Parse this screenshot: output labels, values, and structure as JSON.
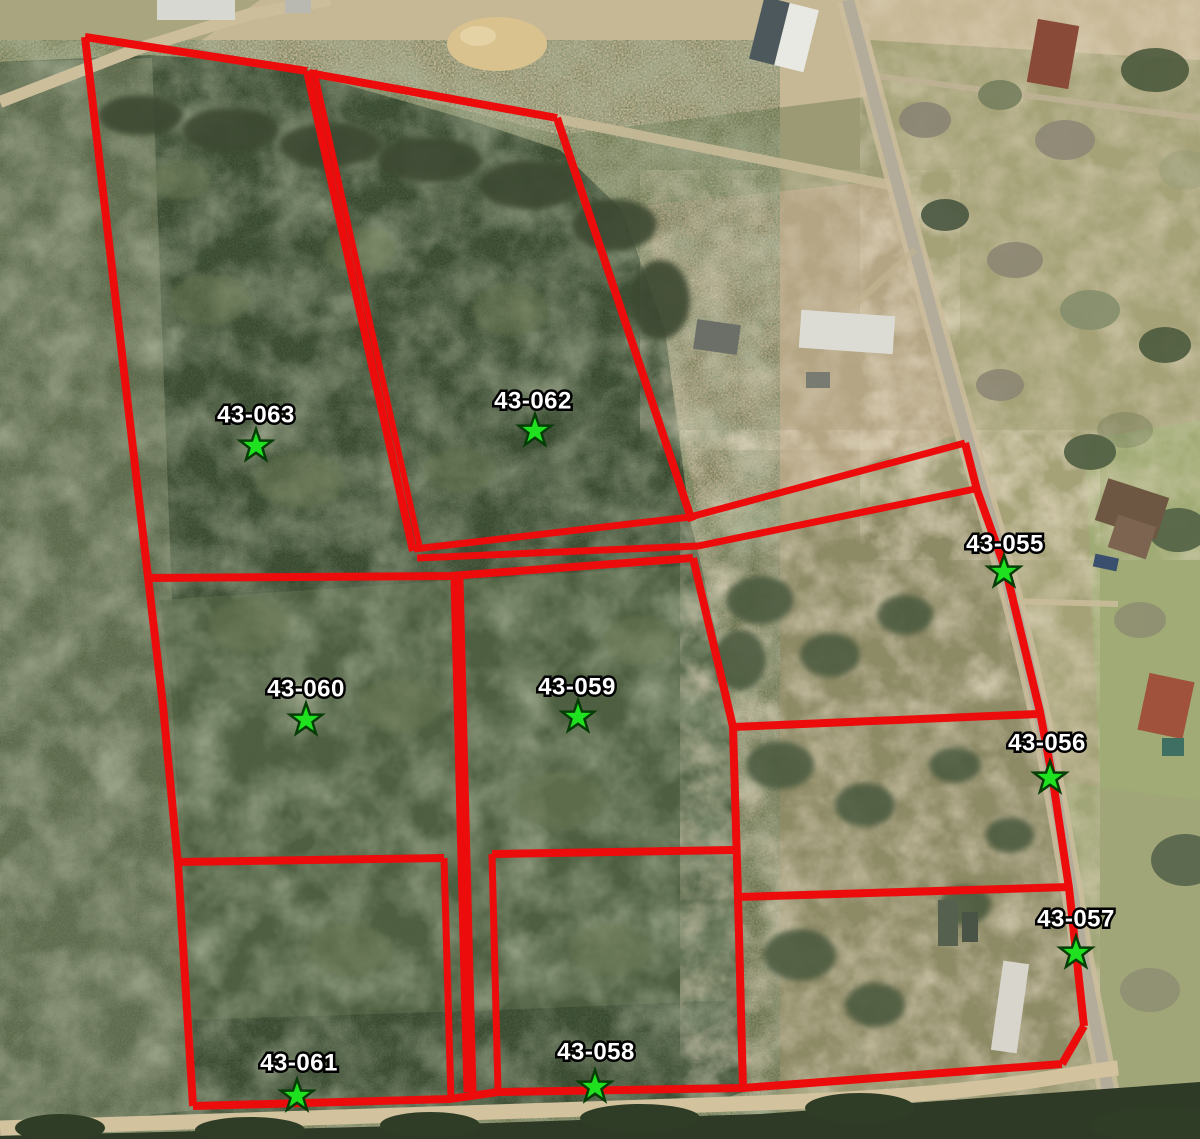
{
  "map": {
    "title": "Parcel overview aerial map",
    "boundary_color": "#ec0c0c",
    "marker": {
      "fill": "#1fe11f",
      "stroke": "#063c06",
      "outer_radius": 17,
      "inner_radius": 6.8
    },
    "label_style": {
      "fill": "#ffffff",
      "outline": "#000000"
    },
    "parcels": [
      {
        "id": "43-063",
        "label": {
          "x": 256,
          "y": 416
        },
        "star": {
          "x": 256,
          "y": 446
        }
      },
      {
        "id": "43-062",
        "label": {
          "x": 533,
          "y": 402
        },
        "star": {
          "x": 535,
          "y": 431
        }
      },
      {
        "id": "43-060",
        "label": {
          "x": 306,
          "y": 690
        },
        "star": {
          "x": 306,
          "y": 720
        }
      },
      {
        "id": "43-059",
        "label": {
          "x": 577,
          "y": 688
        },
        "star": {
          "x": 578,
          "y": 717
        }
      },
      {
        "id": "43-061",
        "label": {
          "x": 299,
          "y": 1064
        },
        "star": {
          "x": 297,
          "y": 1096
        }
      },
      {
        "id": "43-058",
        "label": {
          "x": 596,
          "y": 1053
        },
        "star": {
          "x": 595,
          "y": 1087
        }
      },
      {
        "id": "43-055",
        "label": {
          "x": 1005,
          "y": 545
        },
        "star": {
          "x": 1004,
          "y": 572
        }
      },
      {
        "id": "43-056",
        "label": {
          "x": 1047,
          "y": 744
        },
        "star": {
          "x": 1050,
          "y": 778
        }
      },
      {
        "id": "43-057",
        "label": {
          "x": 1076,
          "y": 920
        },
        "star": {
          "x": 1076,
          "y": 953
        }
      }
    ],
    "boundaries": [
      {
        "name": "west-line",
        "width": 8,
        "points": [
          [
            85,
            37
          ],
          [
            148,
            577
          ],
          [
            163,
            706
          ],
          [
            178,
            864
          ],
          [
            193,
            1106
          ]
        ]
      },
      {
        "name": "top-63",
        "width": 8,
        "points": [
          [
            85,
            37
          ],
          [
            307,
            71
          ]
        ]
      },
      {
        "name": "divider-63-62-a",
        "width": 8,
        "points": [
          [
            307,
            71
          ],
          [
            413,
            551
          ]
        ]
      },
      {
        "name": "divider-63-62-b",
        "width": 6,
        "points": [
          [
            314,
            70
          ],
          [
            420,
            548
          ]
        ]
      },
      {
        "name": "top-62",
        "width": 8,
        "points": [
          [
            309,
            73
          ],
          [
            557,
            118
          ]
        ]
      },
      {
        "name": "east-62",
        "width": 8,
        "points": [
          [
            557,
            118
          ],
          [
            692,
            521
          ]
        ]
      },
      {
        "name": "lane-north",
        "width": 7,
        "points": [
          [
            414,
            549
          ],
          [
            690,
            517
          ],
          [
            965,
            443
          ]
        ]
      },
      {
        "name": "lane-south",
        "width": 7,
        "points": [
          [
            417,
            558
          ],
          [
            698,
            546
          ],
          [
            975,
            489
          ]
        ]
      },
      {
        "name": "mid-line",
        "width": 8,
        "points": [
          [
            148,
            578
          ],
          [
            450,
            576
          ],
          [
            693,
            558
          ]
        ]
      },
      {
        "name": "corridor",
        "width": 13,
        "points": [
          [
            457,
            578
          ],
          [
            464,
            860
          ],
          [
            470,
            1092
          ]
        ]
      },
      {
        "name": "east-61",
        "width": 7,
        "points": [
          [
            444,
            858
          ],
          [
            451,
            1100
          ]
        ]
      },
      {
        "name": "west-58",
        "width": 7,
        "points": [
          [
            492,
            854
          ],
          [
            498,
            1091
          ]
        ]
      },
      {
        "name": "divider-60-61",
        "width": 8,
        "points": [
          [
            176,
            862
          ],
          [
            444,
            858
          ]
        ]
      },
      {
        "name": "top-58",
        "width": 8,
        "points": [
          [
            492,
            854
          ],
          [
            733,
            850
          ]
        ]
      },
      {
        "name": "east-center-line",
        "width": 8,
        "points": [
          [
            693,
            558
          ],
          [
            722,
            680
          ],
          [
            733,
            727
          ],
          [
            738,
            897
          ],
          [
            743,
            1089
          ]
        ]
      },
      {
        "name": "top-56",
        "width": 8,
        "points": [
          [
            733,
            727
          ],
          [
            1038,
            714
          ]
        ]
      },
      {
        "name": "top-57",
        "width": 8,
        "points": [
          [
            738,
            897
          ],
          [
            1069,
            887
          ]
        ]
      },
      {
        "name": "road-line",
        "width": 8,
        "points": [
          [
            965,
            443
          ],
          [
            977,
            490
          ],
          [
            1006,
            571
          ],
          [
            1040,
            712
          ],
          [
            1053,
            781
          ],
          [
            1069,
            888
          ],
          [
            1084,
            1026
          ]
        ]
      },
      {
        "name": "se-corner",
        "width": 8,
        "points": [
          [
            1084,
            1026
          ],
          [
            1062,
            1064
          ]
        ]
      },
      {
        "name": "bottom-line",
        "width": 8,
        "points": [
          [
            193,
            1106
          ],
          [
            450,
            1099
          ],
          [
            498,
            1092
          ],
          [
            743,
            1088
          ],
          [
            1062,
            1064
          ]
        ]
      }
    ]
  }
}
